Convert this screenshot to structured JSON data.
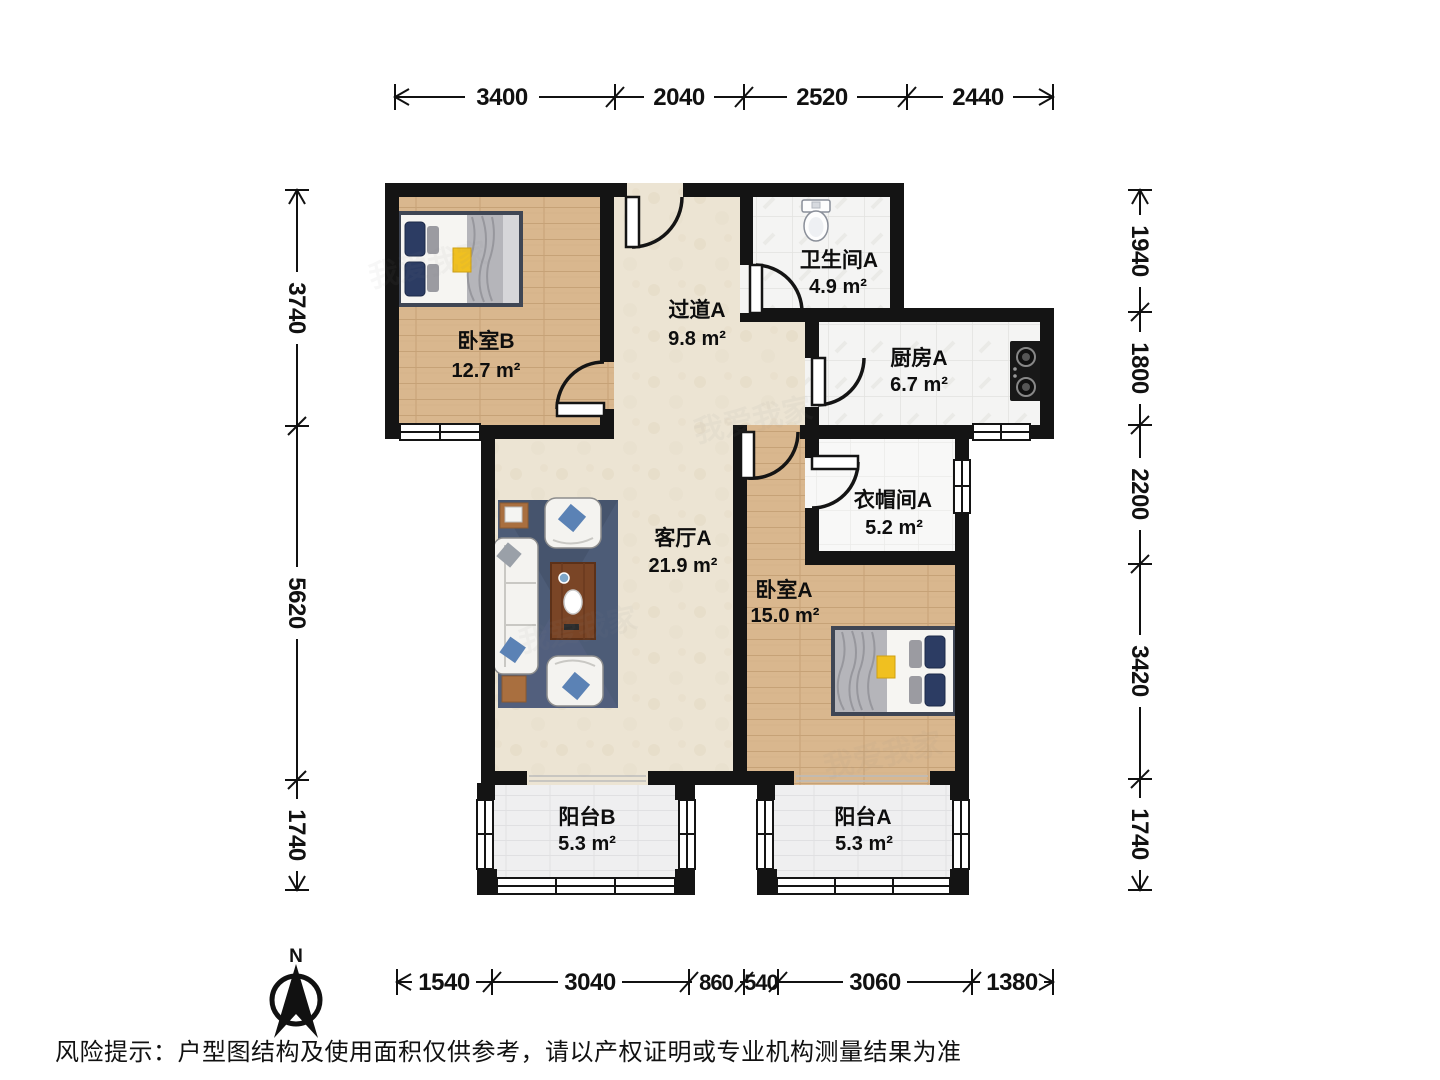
{
  "floorplan": {
    "rooms": [
      {
        "key": "bedroom_b",
        "name": "卧室B",
        "area": "12.7 m²"
      },
      {
        "key": "hallway_a",
        "name": "过道A",
        "area": "9.8 m²"
      },
      {
        "key": "bathroom_a",
        "name": "卫生间A",
        "area": "4.9 m²"
      },
      {
        "key": "kitchen_a",
        "name": "厨房A",
        "area": "6.7 m²"
      },
      {
        "key": "cloakroom_a",
        "name": "衣帽间A",
        "area": "5.2 m²"
      },
      {
        "key": "living_room_a",
        "name": "客厅A",
        "area": "21.9 m²"
      },
      {
        "key": "bedroom_a",
        "name": "卧室A",
        "area": "15.0 m²"
      },
      {
        "key": "balcony_b",
        "name": "阳台B",
        "area": "5.3 m²"
      },
      {
        "key": "balcony_a",
        "name": "阳台A",
        "area": "5.3 m²"
      }
    ],
    "dimensions_mm": {
      "top": [
        "3400",
        "2040",
        "2520",
        "2440"
      ],
      "left": [
        "3740",
        "5620",
        "1740"
      ],
      "right": [
        "1940",
        "1800",
        "2200",
        "3420",
        "1740"
      ],
      "bottom": [
        "1540",
        "3040",
        "860",
        "540",
        "3060",
        "1380"
      ]
    },
    "compass": {
      "label": "N"
    },
    "watermark": {
      "text": "我爱我家"
    },
    "disclaimer": "风险提示：户型图结构及使用面积仅供参考，请以产权证明或专业机构测量结果为准"
  },
  "colors": {
    "wall": "#141414",
    "wood_floor": "#d9b78e",
    "tile_beige": "#ece4d3",
    "tile_white": "#f4f4f3",
    "balcony_tile": "#efeff0",
    "rug_blue": "#4d5c77",
    "table_brown": "#7a4526",
    "pillow_navy": "#2c3c63",
    "accent_yellow": "#f0c020"
  }
}
